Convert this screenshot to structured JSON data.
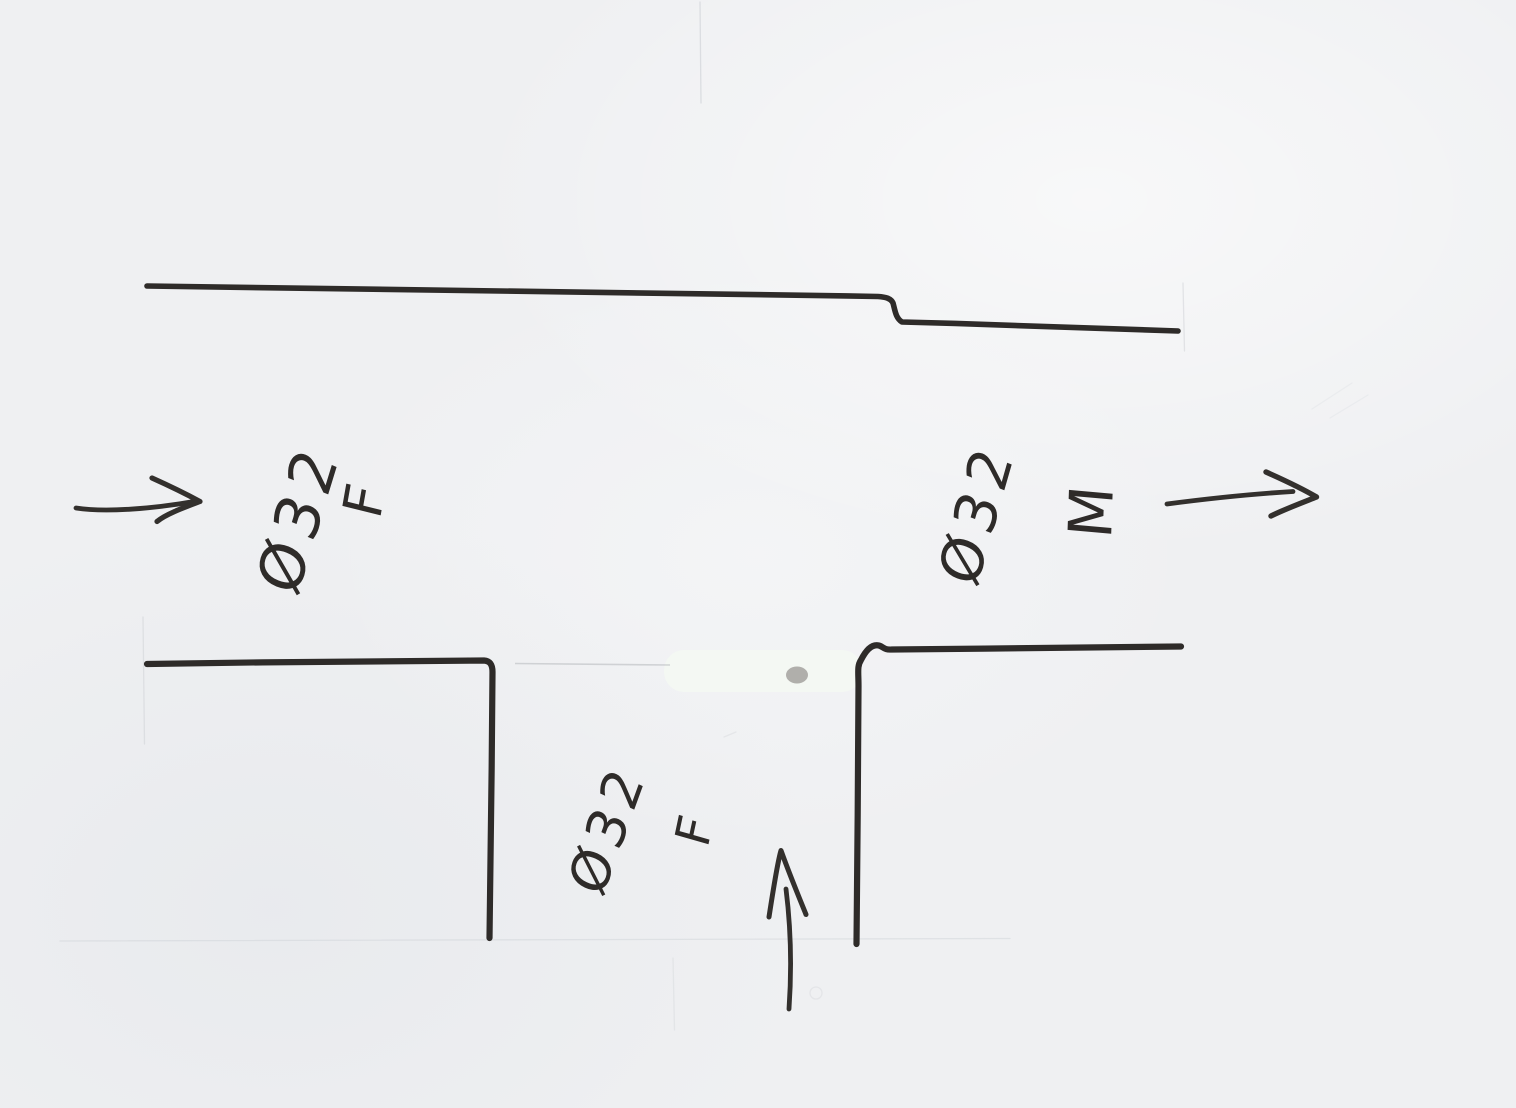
{
  "sketch": {
    "description": "hand-drawn pipe tee fitting cross-section",
    "ports": {
      "left": {
        "diameter": "Ø32",
        "gender": "F",
        "flow_direction": "right"
      },
      "right": {
        "diameter": "Ø32",
        "gender": "M",
        "flow_direction": "right"
      },
      "bottom": {
        "diameter": "Ø32",
        "gender": "F",
        "flow_direction": "up"
      }
    }
  },
  "colors": {
    "paper": "#eff0f2",
    "ink": "#2e2b29",
    "arrow_ink": "#33302d",
    "pencil_crease": "#c9ccd1",
    "whiteout_patch": "#f3f8f2",
    "smudge": "#a8a6a3"
  }
}
